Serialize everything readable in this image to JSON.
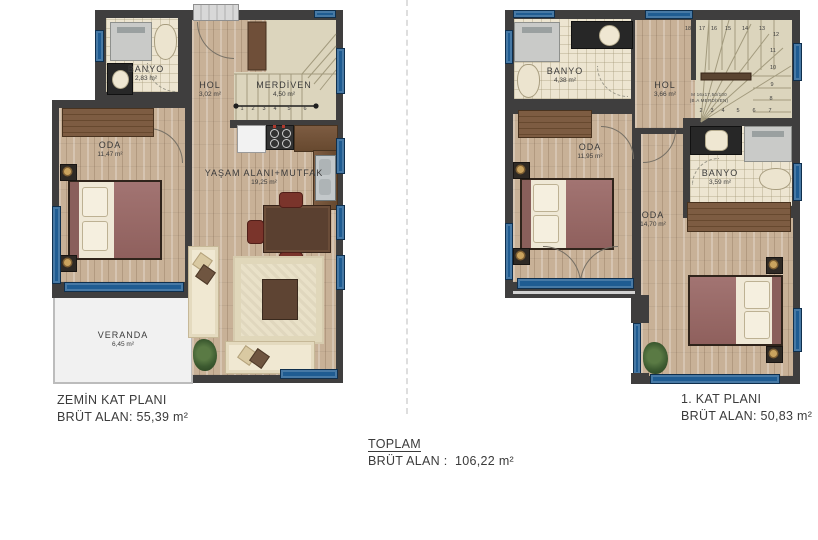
{
  "colors": {
    "wall": "#3f3e3e",
    "window_blue": "#1f5c92",
    "wood_floor": "#c8b197",
    "tile_floor": "#ede5d1",
    "stair_floor": "#dcd5bd",
    "bed_maroon": "#9c6e6a"
  },
  "ground_floor": {
    "caption_title": "ZEMİN KAT PLANI",
    "caption_area": "BRÜT ALAN: 55,39 m²",
    "rooms": {
      "banyo": {
        "name": "BANYO",
        "area": "2,83 m²"
      },
      "hol": {
        "name": "HOL",
        "area": "3,02 m²"
      },
      "merdiven": {
        "name": "MERDİVEN",
        "area": "4,50 m²"
      },
      "oda": {
        "name": "ODA",
        "area": "11,47 m²"
      },
      "yasam": {
        "name": "YAŞAM ALANI+MUTFAK",
        "area": "19,25 m²"
      },
      "veranda": {
        "name": "VERANDA",
        "area": "6,45 m²"
      }
    },
    "stair_numbers": [
      "1",
      "2",
      "3",
      "4",
      "5",
      "6"
    ]
  },
  "first_floor": {
    "caption_title": "1. KAT PLANI",
    "caption_area": "BRÜT ALAN: 50,83 m²",
    "rooms": {
      "banyo_ust": {
        "name": "BANYO",
        "area": "4,38 m²"
      },
      "hol": {
        "name": "HOL",
        "area": "3,66 m²"
      },
      "oda_sol": {
        "name": "ODA",
        "area": "11,95 m²"
      },
      "banyo_orta": {
        "name": "BANYO",
        "area": "3,59 m²"
      },
      "oda_alt": {
        "name": "ODA",
        "area": "14,70 m²"
      }
    },
    "stair_annotation": [
      "M 16x17,50/100",
      "(B.A MERDİVEN)"
    ],
    "stair_numbers_top": [
      "18",
      "17",
      "16",
      "15",
      "14",
      "13",
      "12"
    ],
    "stair_numbers_right": [
      "11",
      "10",
      "9",
      "8"
    ],
    "stair_numbers_bottom": [
      "2",
      "3",
      "4",
      "5",
      "6",
      "7"
    ]
  },
  "total": {
    "label": "TOPLAM",
    "area_line": "BRÜT ALAN :  106,22 m²"
  }
}
